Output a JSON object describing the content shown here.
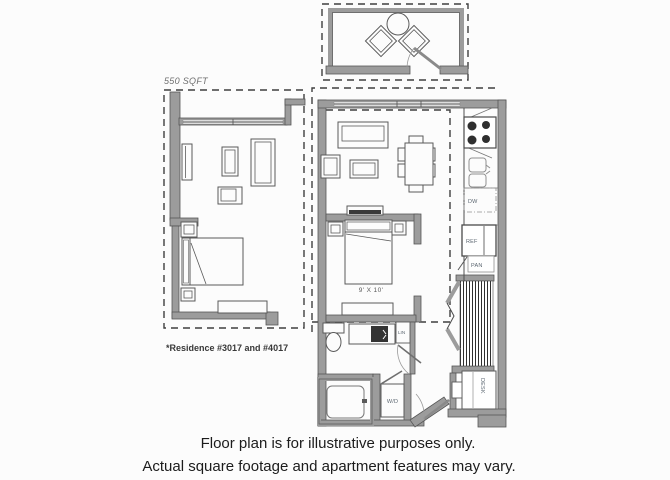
{
  "floorplan": {
    "area_label": "550 SQFT",
    "residence_note": "*Residence #3017 and #4017",
    "bedroom_dimensions": "9' X 10'",
    "labels": {
      "dishwasher": "DW",
      "refrigerator": "REF",
      "pantry": "PAN",
      "linen": "LIN",
      "washer_dryer": "W/D",
      "desk": "DESK"
    }
  },
  "disclaimer": {
    "line1": "Floor plan is for illustrative purposes only.",
    "line2": "Actual square footage and apartment features may vary."
  },
  "colors": {
    "background": "#fcfcfc",
    "wall_fill": "#9c9c9c",
    "wall_stroke": "#565656",
    "line": "#5a5a5a",
    "dashed_outline": "#3f3f3f",
    "burner": "#2f2f2f",
    "appliance_text": "#5b6670",
    "disclaimer_text": "#1c1c1c"
  }
}
